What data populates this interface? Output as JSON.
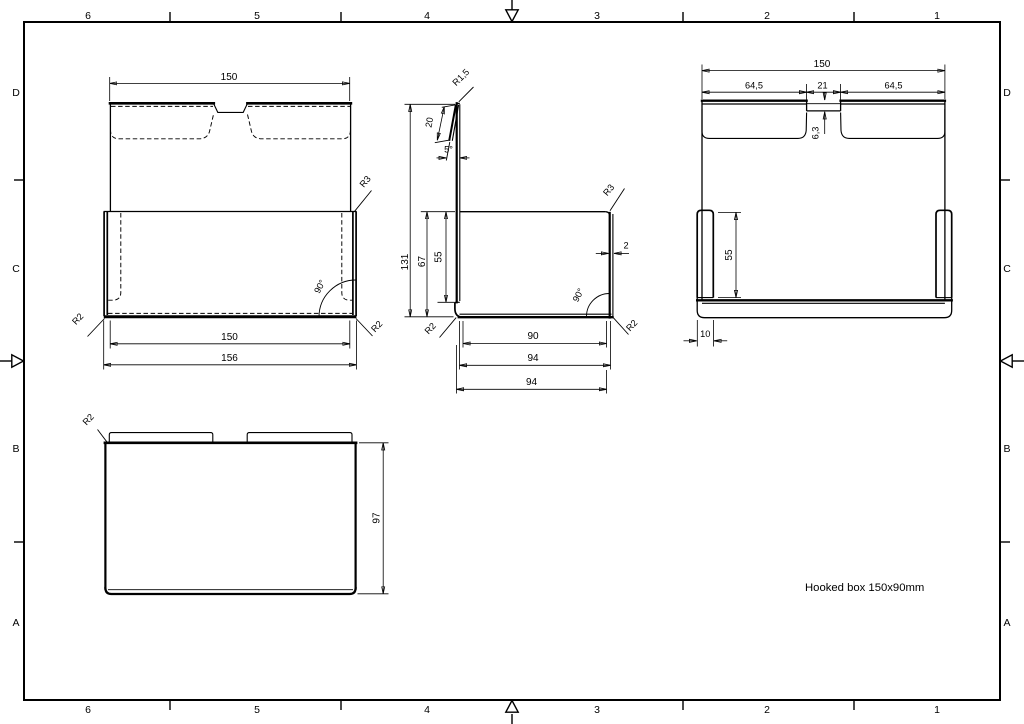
{
  "frame": {
    "columns": [
      "6",
      "5",
      "4",
      "3",
      "2",
      "1"
    ],
    "rows": [
      "D",
      "C",
      "B",
      "A"
    ]
  },
  "title": {
    "text": "Hooked box 150x90mm"
  },
  "front": {
    "width_top": "150",
    "width_bottom": "150",
    "width_overall": "156",
    "corner_radius_top_right": "R3",
    "bend_angle": "90°",
    "radius_bottom_left": "R2",
    "radius_bottom_right": "R2"
  },
  "side": {
    "height_overall": "131",
    "hook_length": "20",
    "hook_angle": "5°",
    "hook_radius": "R1,5",
    "height_outer": "67",
    "height_inner": "55",
    "corner_radius_top_right": "R3",
    "thickness": "2",
    "bend_angle": "90°",
    "radius_bottom_left": "R2",
    "radius_bottom_right": "R2",
    "width_inner": "90",
    "width_outer": "94",
    "width_overall": "94"
  },
  "back": {
    "width_top": "150",
    "tab_left": "64,5",
    "notch_width": "21",
    "tab_right": "64,5",
    "notch_depth": "6,3",
    "flange_height": "55",
    "flange_width": "10"
  },
  "top": {
    "corner_radius": "R2",
    "depth": "97"
  }
}
